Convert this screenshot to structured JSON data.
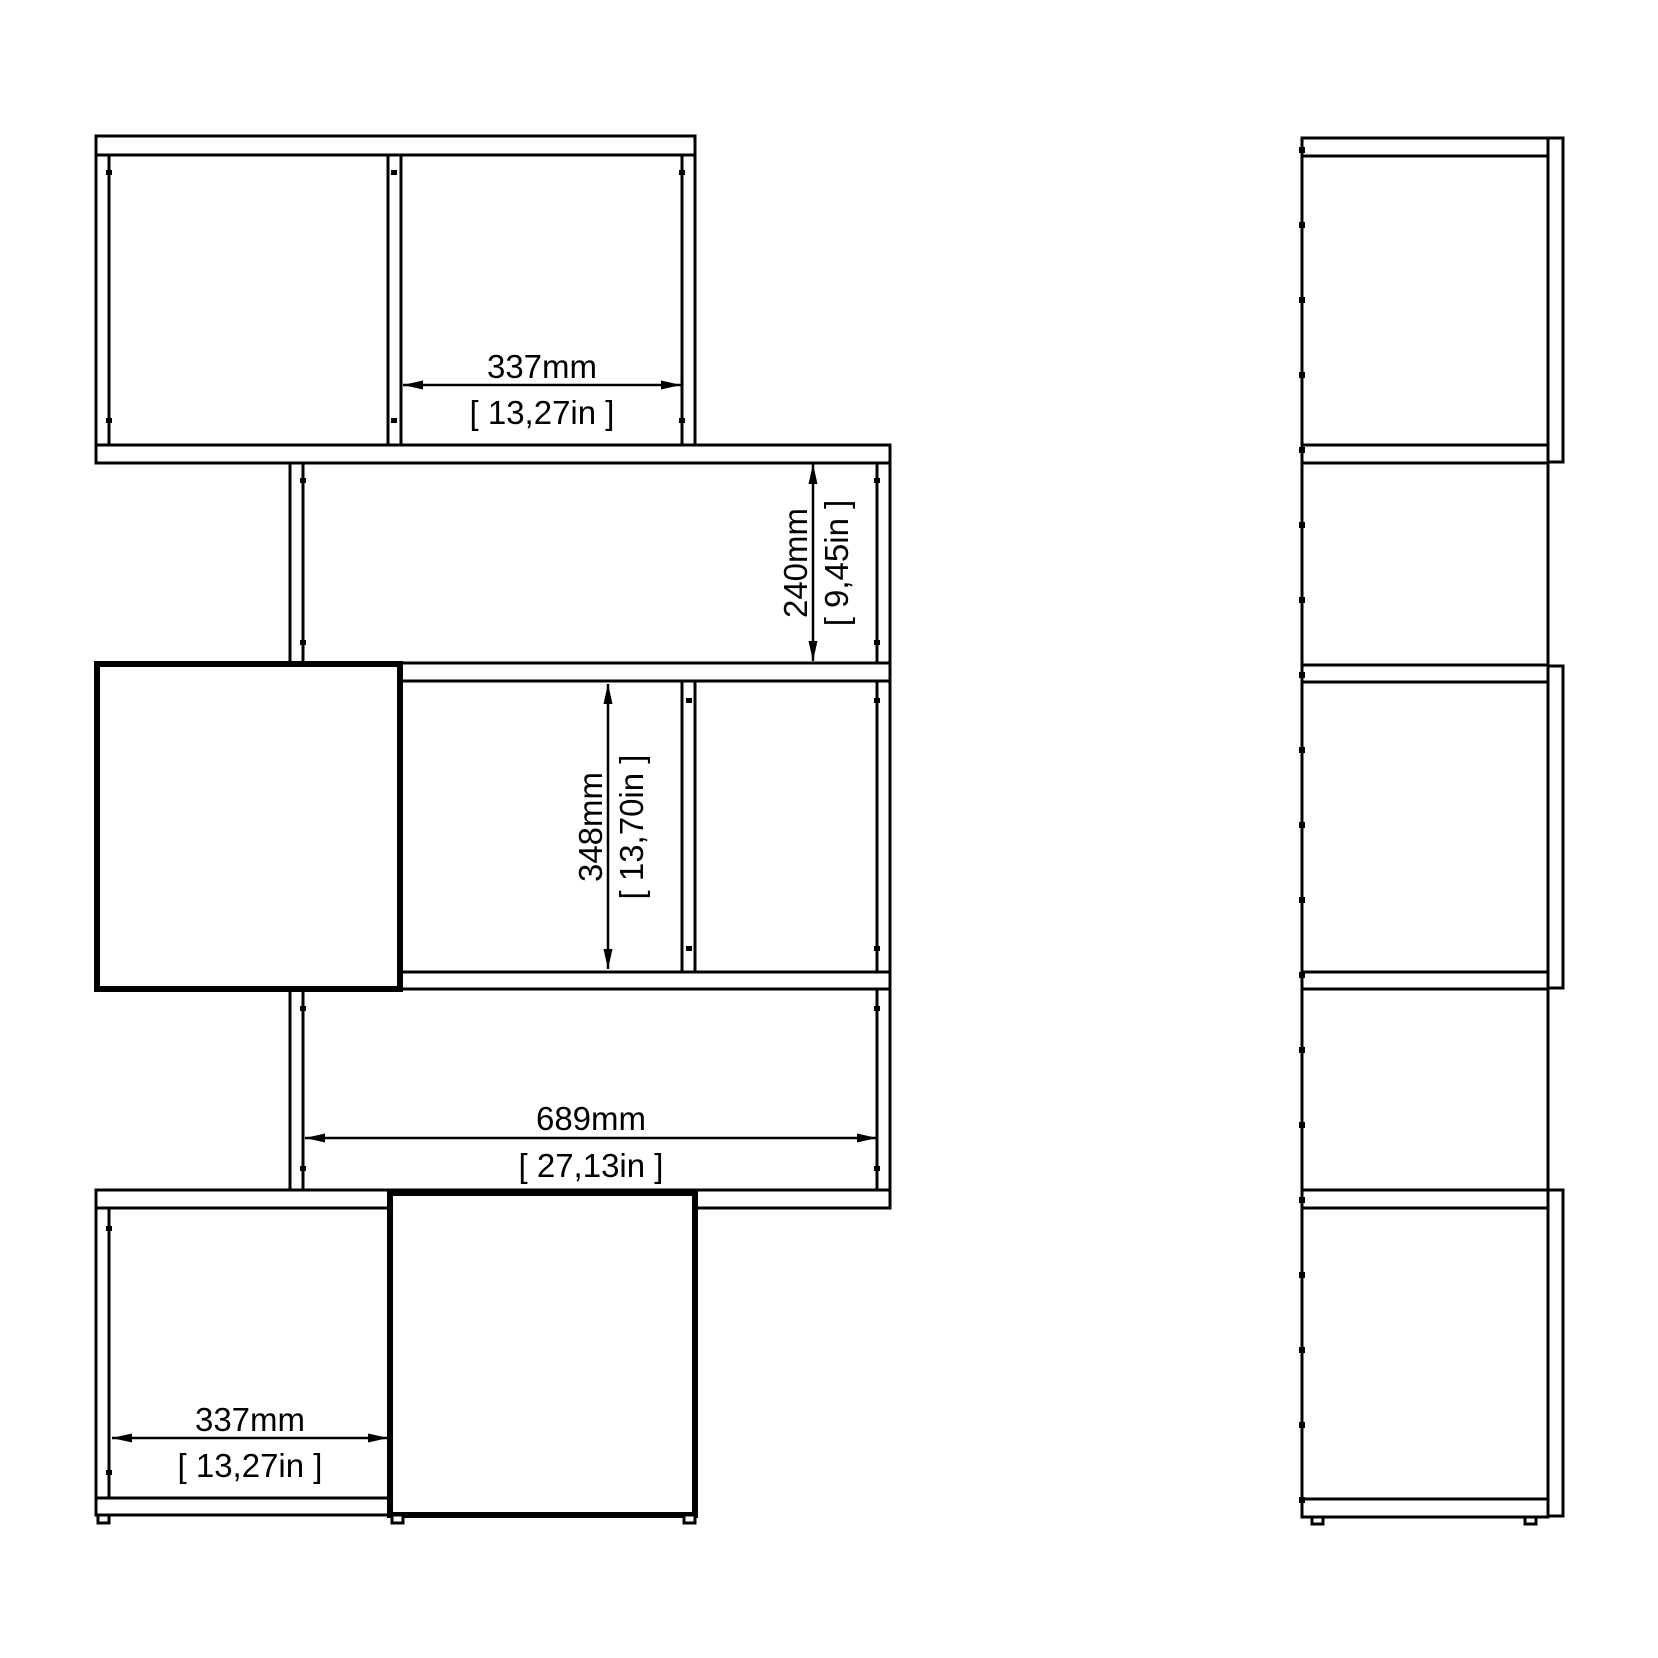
{
  "drawing": {
    "type": "furniture technical drawing, zigzag bookcase, front and side orthographic views",
    "background_color": "#ffffff",
    "line_color": "#000000",
    "dimensions": {
      "top_compartment_width": {
        "mm": "337mm",
        "inches": "[ 13,27in ]"
      },
      "shelf_opening_height": {
        "mm": "240mm",
        "inches": "[ 9,45in ]"
      },
      "middle_opening_height": {
        "mm": "348mm",
        "inches": "[ 13,70in ]"
      },
      "interior_width": {
        "mm": "689mm",
        "inches": "[ 27,13in ]"
      },
      "bottom_compartment_width": {
        "mm": "337mm",
        "inches": "[ 13,27in ]"
      }
    }
  }
}
